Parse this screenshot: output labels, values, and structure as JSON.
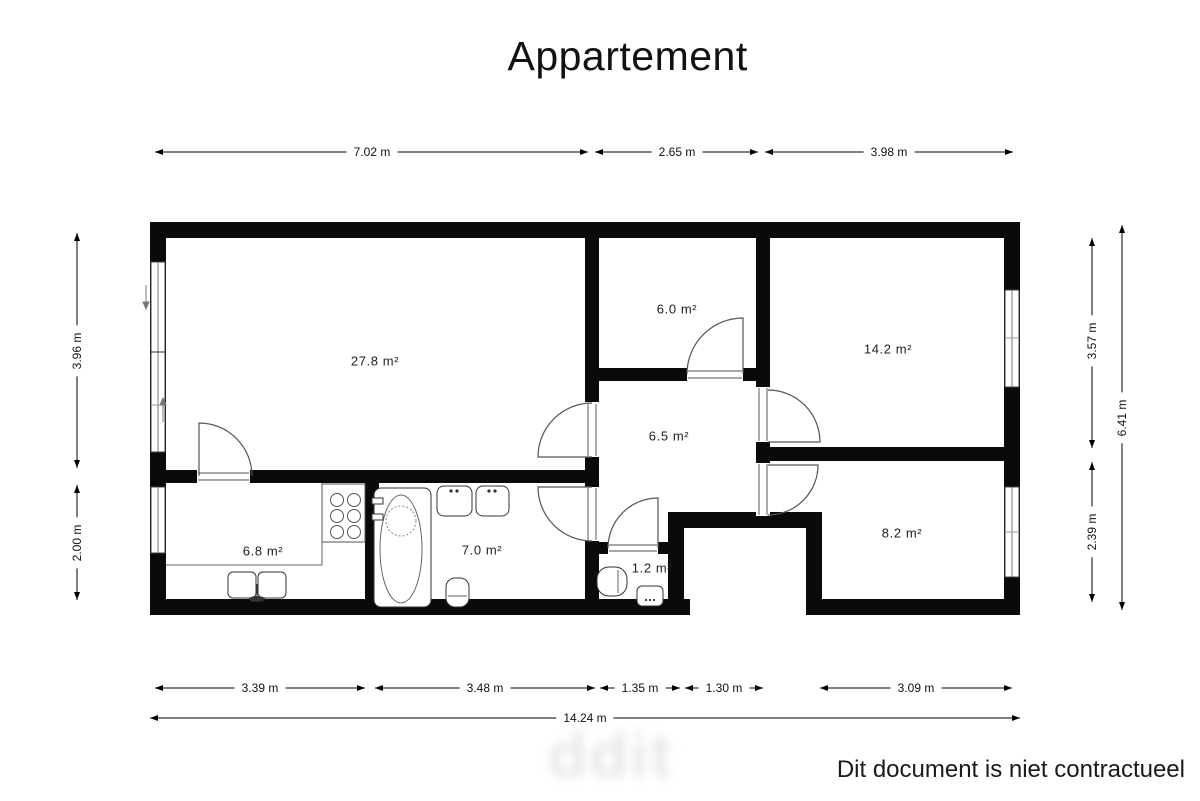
{
  "title": "Appartement",
  "plan": {
    "rooms": [
      {
        "name": "living-room",
        "area": "27.8 m²"
      },
      {
        "name": "storage-room",
        "area": "6.0 m²"
      },
      {
        "name": "bedroom-top-right",
        "area": "14.2 m²"
      },
      {
        "name": "hallway",
        "area": "6.5 m²"
      },
      {
        "name": "kitchen",
        "area": "6.8 m²"
      },
      {
        "name": "bathroom",
        "area": "7.0 m²"
      },
      {
        "name": "wc",
        "area": "1.2 m²"
      },
      {
        "name": "bedroom-bottom-right",
        "area": "8.2 m²"
      }
    ],
    "wall_color": "#0a0a0a",
    "door_color": "#555555"
  },
  "dimensions": {
    "top": [
      "7.02 m",
      "2.65 m",
      "3.98 m"
    ],
    "bottom": [
      "3.39 m",
      "3.48 m",
      "1.35 m",
      "1.30 m",
      "3.09 m"
    ],
    "bottom_total": "14.24 m",
    "left": [
      "3.96 m",
      "2.00 m"
    ],
    "right": [
      "3.57 m",
      "2.39 m"
    ],
    "right_total": "6.41 m"
  },
  "watermark": "ddit",
  "footer": "Dit document is niet contractueel"
}
